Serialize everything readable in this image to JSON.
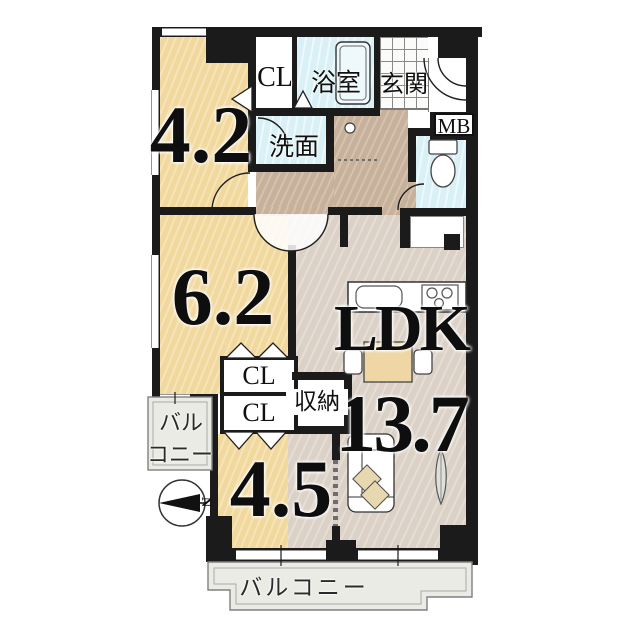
{
  "plan": {
    "rooms": {
      "r42": {
        "label": "4.2"
      },
      "r62": {
        "label": "6.2"
      },
      "r45": {
        "label": "4.5"
      },
      "ldk": {
        "label": "LDK",
        "area": "13.7"
      }
    },
    "labels": {
      "cl_top": "CL",
      "bath": "浴室",
      "entrance": "玄関",
      "mb": "MB",
      "wash": "洗面",
      "cl_mid_1": "CL",
      "cl_mid_2": "CL",
      "storage": "収納",
      "balcony_left_line1": "バル",
      "balcony_left_line2": "コニー",
      "balcony_bottom": "バルコニー",
      "compass_north": "N"
    },
    "colors": {
      "wall": "#1b1b1b",
      "room_tan": "#f1d89d",
      "ldk_floor": "#dbd1c6",
      "hall_floor": "#c7b19a",
      "wet_blue": "#d9f1f6",
      "balcony_grey": "#ebebe6",
      "text": "#101010"
    }
  }
}
